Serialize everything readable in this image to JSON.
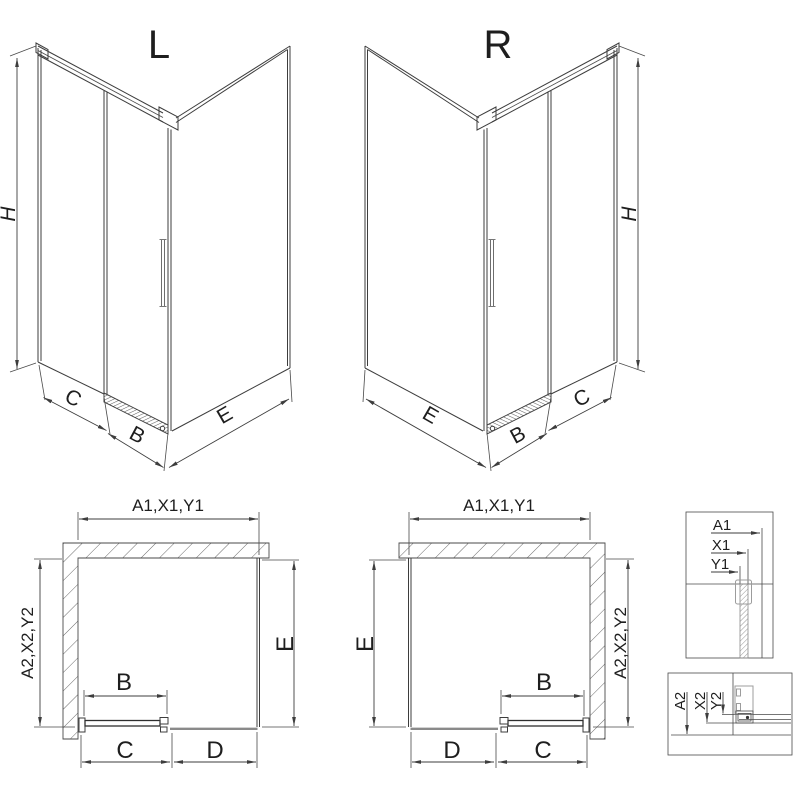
{
  "colors": {
    "line": "#3d3d3d",
    "hatch": "#6a6a6a",
    "dense_hatch": "#8a8a8a",
    "profile_gray": "#9c9c9c",
    "text": "#1e1e1e",
    "background": "#ffffff"
  },
  "iso_left": {
    "title": "L",
    "dim_height": "H",
    "dim_side": "C",
    "dim_door": "B",
    "dim_return": "E"
  },
  "iso_right": {
    "title": "R",
    "dim_height": "H",
    "dim_side": "C",
    "dim_door": "B",
    "dim_return": "E"
  },
  "plan_left": {
    "dim_width": "A1,X1,Y1",
    "dim_depth": "A2,X2,Y2",
    "dim_return": "E",
    "dim_door": "B",
    "dim_side": "C",
    "dim_fixed": "D"
  },
  "plan_right": {
    "dim_width": "A1,X1,Y1",
    "dim_depth": "A2,X2,Y2",
    "dim_return": "E",
    "dim_door": "B",
    "dim_side": "C",
    "dim_fixed": "D"
  },
  "detail_width": {
    "a1": "A1",
    "x1": "X1",
    "y1": "Y1"
  },
  "detail_depth": {
    "a2": "A2",
    "x2": "X2",
    "y2": "Y2"
  }
}
